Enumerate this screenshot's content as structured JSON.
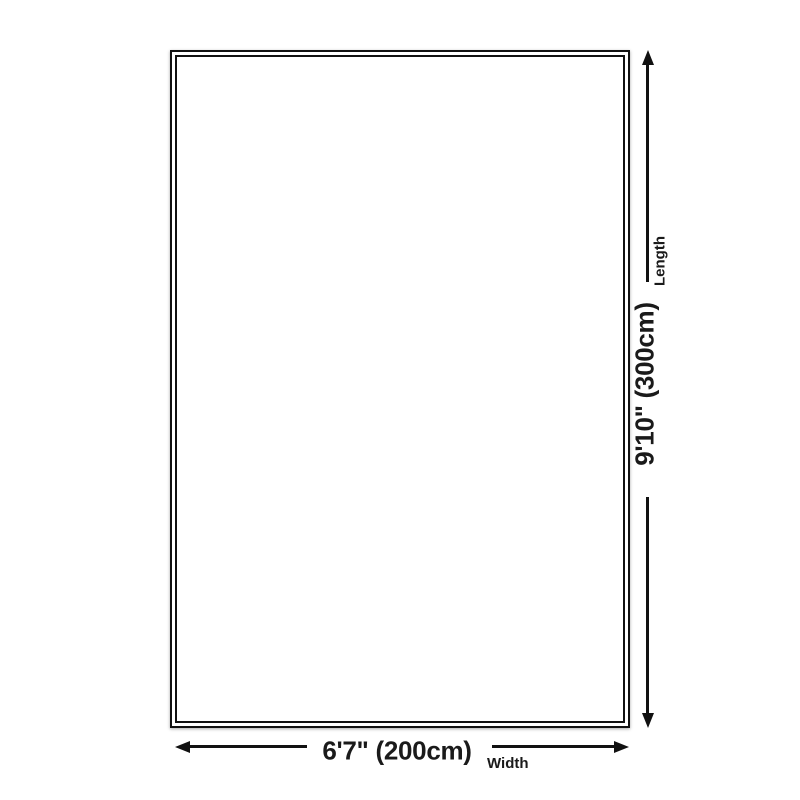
{
  "page": {
    "background_color": "#ffffff",
    "line_color": "#111111",
    "text_color": "#1a1a1a"
  },
  "diagram": {
    "type": "product-dimension-diagram",
    "shape": "rectangle-with-double-border",
    "length": {
      "value": "9'10\" (300cm)",
      "label": "Length"
    },
    "width": {
      "value": "6'7\" (200cm)",
      "label": "Width"
    }
  }
}
